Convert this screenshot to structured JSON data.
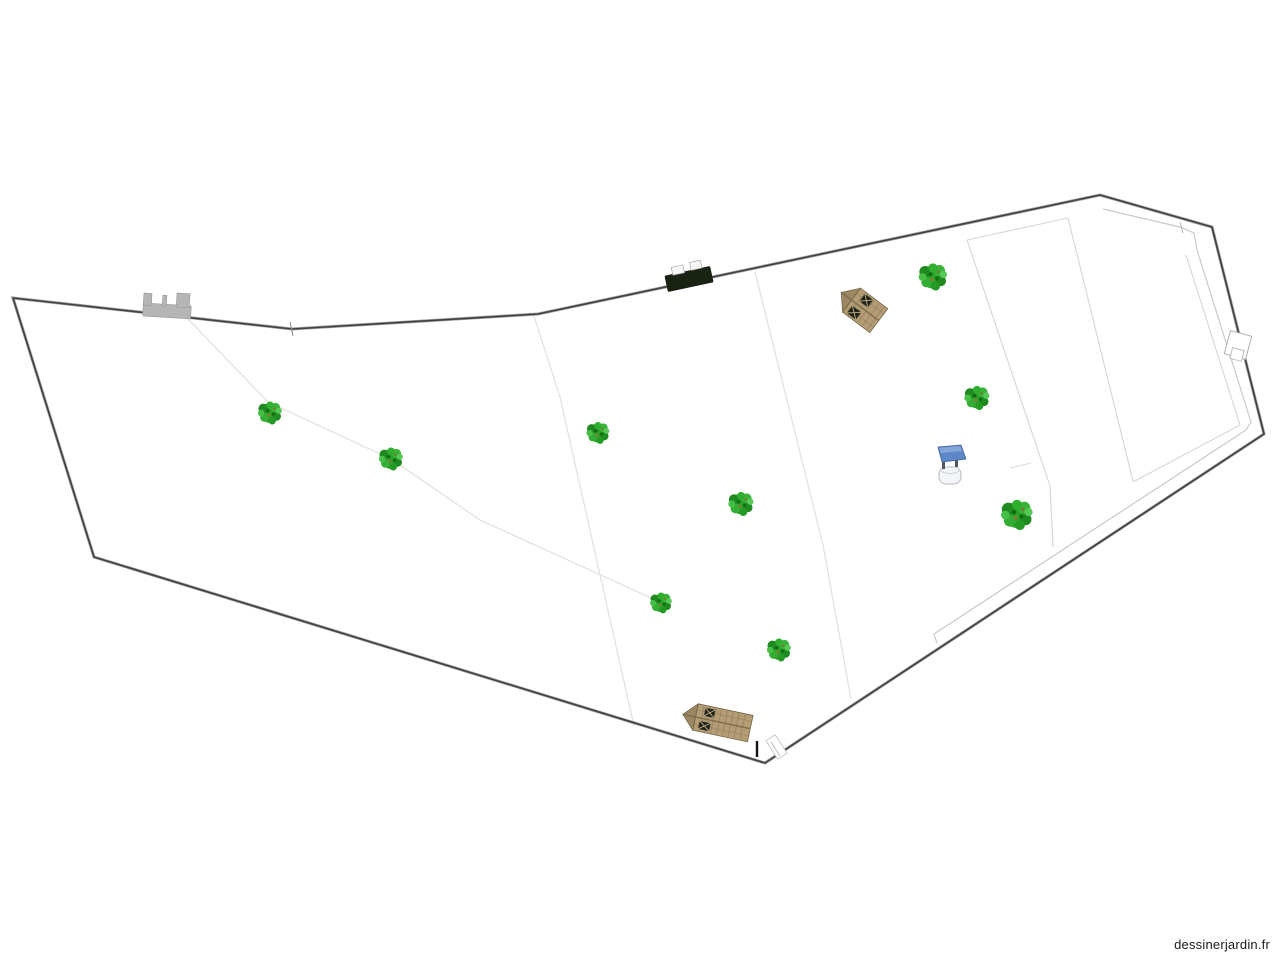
{
  "watermark": {
    "text": "dessinerjardin.fr",
    "color": "#1a1a1a"
  },
  "canvas": {
    "w": 1280,
    "h": 960,
    "bg": "#ffffff"
  },
  "palette": {
    "boundary_core": "#424242",
    "boundary_halo": "#a0a0a0",
    "shed_body": "#b49c74",
    "shed_gable": "#9c8763",
    "shed_trim": "#6b5c40",
    "shed_ridge": "#7d6c4c",
    "shed_window": "#20211a",
    "shed_window_cross": "#c3b186",
    "gate_gray": "#b5b5b5",
    "gate_gray_stroke": "#979797",
    "gate_dark": "#1a2212",
    "gate_dark_stroke": "#10150c",
    "well_roof": "#5d87c6",
    "tree_green": "#2ba32b"
  },
  "boundary": {
    "points": "13,298 292,329 538,314 1100,195 1212,227 1264,434 765,763 94,557"
  },
  "interior_lines": [
    {
      "name": "hedge-diagonal",
      "points": "187,318 268,402 391,459 480,520 660,602",
      "color": "#e2e2e2",
      "w": 1.3
    },
    {
      "name": "divider-a",
      "points": "533,313 560,397 634,726",
      "color": "#e0e0e0",
      "w": 1.2
    },
    {
      "name": "divider-b",
      "points": "755,272 823,545 851,699",
      "color": "#e0e0e0",
      "w": 1.2
    },
    {
      "name": "inner-top-edge",
      "points": "967,240 1068,218",
      "color": "#d6d6d6",
      "w": 1.1
    },
    {
      "name": "band-left-edge",
      "points": "967,240 1050,486 1053,547",
      "color": "#d6d6d6",
      "w": 1.1
    },
    {
      "name": "band-right-edge",
      "points": "1068,218 1133,481",
      "color": "#d6d6d6",
      "w": 1.1
    },
    {
      "name": "court-right-edge",
      "points": "1186,255 1240,425",
      "color": "#d6d6d6",
      "w": 1.1
    },
    {
      "name": "court-bottom-edge",
      "points": "1240,425 1133,482",
      "color": "#d6d6d6",
      "w": 1.1
    },
    {
      "name": "inner-outline",
      "points": "1103,209 1180,227 1194,233 1197,250 1251,422 1246,430 934,634 937,643",
      "color": "#c9c9c9",
      "w": 1.2
    },
    {
      "name": "well-stub",
      "points": "1010,468 1031,463",
      "color": "#dcdcdc",
      "w": 1.1
    }
  ],
  "patches": [
    {
      "name": "right-boundary-opening-outer",
      "x": 1227,
      "y": 333,
      "w": 22,
      "h": 24,
      "angle": 15,
      "fill": "#ffffff",
      "stroke": "#a9a9a9"
    },
    {
      "name": "right-boundary-opening-inner",
      "x": 1231,
      "y": 349,
      "w": 12,
      "h": 11,
      "angle": 15,
      "fill": "#ffffff",
      "stroke": "#b5b5b5"
    },
    {
      "name": "corner-opening",
      "x": 771,
      "y": 736,
      "w": 11,
      "h": 22,
      "angle": -33,
      "fill": "#ffffff",
      "stroke": "#c6c6c6"
    }
  ],
  "ticks": [
    {
      "name": "vertex-tick",
      "x1": 290,
      "y1": 322,
      "x2": 293,
      "y2": 336,
      "color": "#8a8a8a",
      "w": 1
    },
    {
      "name": "junction-tick",
      "x1": 1180,
      "y1": 222,
      "x2": 1183,
      "y2": 233,
      "color": "#b5b5b5",
      "w": 1
    },
    {
      "name": "corner-opening-mark",
      "x1": 771,
      "y1": 742,
      "x2": 780,
      "y2": 756,
      "color": "#bdbdbd",
      "w": 1
    },
    {
      "name": "post-marker",
      "x1": 757,
      "y1": 741,
      "x2": 757,
      "y2": 757,
      "color": "#151515",
      "w": 2.4
    }
  ],
  "trees": [
    {
      "x": 270,
      "y": 413,
      "s": 1.1
    },
    {
      "x": 391,
      "y": 459,
      "s": 1.1
    },
    {
      "x": 598,
      "y": 433,
      "s": 1.05
    },
    {
      "x": 741,
      "y": 504,
      "s": 1.15
    },
    {
      "x": 661,
      "y": 603,
      "s": 1.0
    },
    {
      "x": 779,
      "y": 650,
      "s": 1.1
    },
    {
      "x": 933,
      "y": 277,
      "s": 1.3
    },
    {
      "x": 977,
      "y": 398,
      "s": 1.15
    },
    {
      "x": 1017,
      "y": 515,
      "s": 1.45
    }
  ],
  "tree_icon_blobs": [
    [
      0,
      0,
      9,
      "#2ba32b"
    ],
    [
      -6,
      -4,
      4.5,
      "#1f8a1f"
    ],
    [
      5,
      -5,
      4.2,
      "#3ab33a"
    ],
    [
      6,
      3,
      4,
      "#1f8a1f"
    ],
    [
      -5,
      4,
      4,
      "#33ad33"
    ],
    [
      0,
      -7,
      3.5,
      "#2fae2f"
    ],
    [
      -8,
      0,
      3,
      "#46bf46"
    ],
    [
      2,
      7,
      3.4,
      "#259a25"
    ],
    [
      8,
      -2,
      2.8,
      "#57c957"
    ],
    [
      -2,
      -2,
      1.6,
      "#116d11"
    ],
    [
      3,
      1,
      1.5,
      "#0f6f0f"
    ],
    [
      -1,
      2,
      1.2,
      "#9a7333"
    ],
    [
      4,
      -4,
      1,
      "#8a6a30"
    ]
  ],
  "sheds": [
    {
      "name": "small-shed",
      "x": 862,
      "y": 308,
      "len": 42,
      "wid": 30,
      "angle": 37,
      "windows": [
        {
          "x": -6,
          "y": -13,
          "w": 10,
          "h": 9
        },
        {
          "x": -9,
          "y": 4,
          "w": 11,
          "h": 9
        }
      ]
    },
    {
      "name": "long-shed",
      "x": 719,
      "y": 722,
      "len": 64,
      "wid": 27,
      "angle": 12,
      "windows": [
        {
          "x": -16,
          "y": -11,
          "w": 10,
          "h": 8
        },
        {
          "x": -19,
          "y": 3,
          "w": 11,
          "h": 8
        }
      ]
    }
  ],
  "gates": [
    {
      "name": "entrance-gate",
      "kind": "light",
      "x": 144,
      "y": 293,
      "angle": 3.5,
      "bar": [
        0,
        10,
        48,
        13
      ],
      "tabs": [
        [
          0,
          0,
          8,
          12
        ],
        [
          19,
          1,
          4,
          11
        ],
        [
          33,
          -2,
          13,
          14
        ]
      ]
    },
    {
      "name": "field-gate",
      "kind": "dark",
      "x": 689,
      "y": 279,
      "angle": -12,
      "bar": [
        -23,
        -8,
        46,
        16
      ],
      "tabs": [
        [
          -15,
          -15,
          12,
          8
        ],
        [
          4,
          -16,
          11,
          8
        ]
      ]
    }
  ],
  "well": {
    "x": 951,
    "y": 465,
    "polys": [
      {
        "points": "-13,-18 10,-20 15,-6 -9,-3",
        "fill": "#5d87c6",
        "stroke": "#41639b"
      },
      {
        "points": "-12,-17 9,-19 11,-14 -10,-12",
        "fill": "#83a5d9",
        "stroke": "none"
      }
    ],
    "rects": [
      {
        "x": -9,
        "y": -7,
        "w": 3,
        "h": 11,
        "fill": "#53575c"
      },
      {
        "x": 4,
        "y": -9,
        "w": 3,
        "h": 11,
        "fill": "#53575c"
      },
      {
        "x": -12,
        "y": 2,
        "w": 22,
        "h": 17,
        "rx": 7,
        "fill": "#f3f5f9",
        "stroke": "#b5bac2"
      }
    ],
    "ellipse": {
      "cx": -1,
      "cy": 5,
      "rx": 9,
      "ry": 3.5,
      "stroke": "#cdd2da"
    }
  }
}
